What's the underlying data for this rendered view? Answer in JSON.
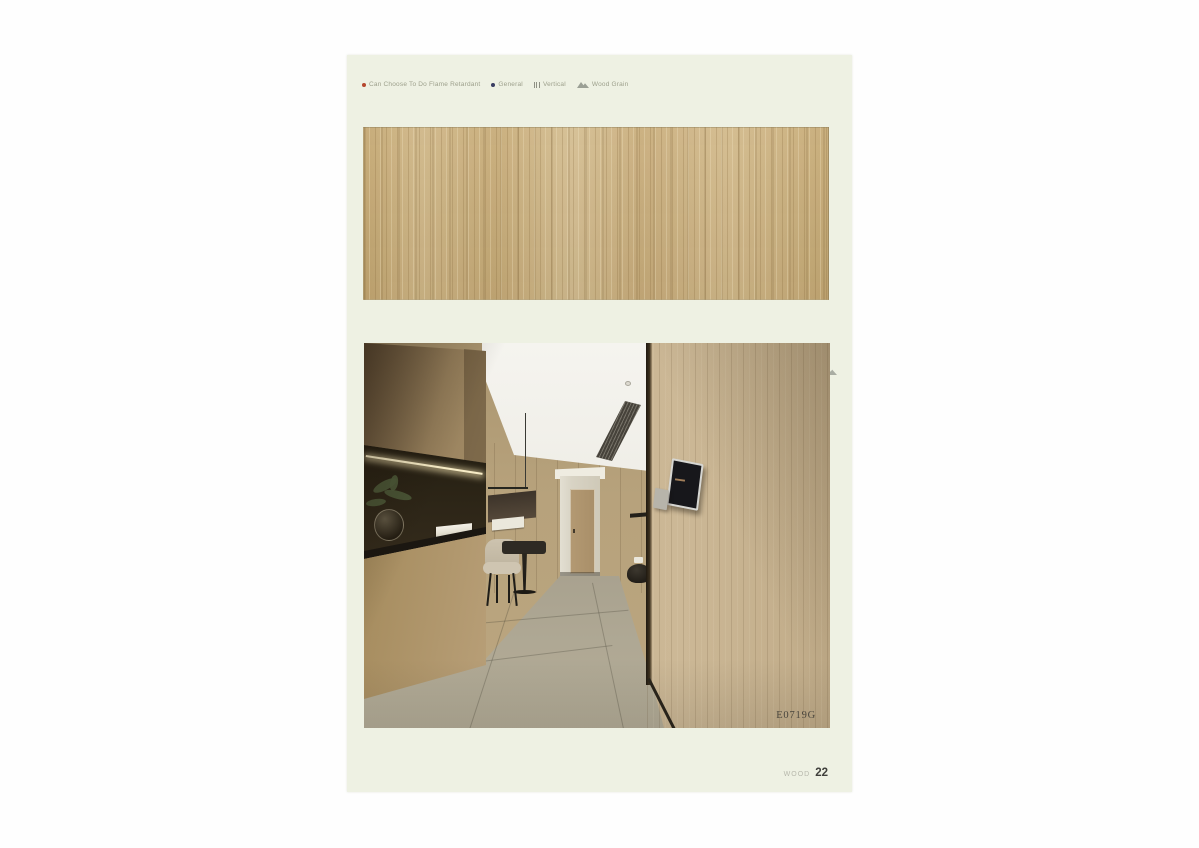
{
  "legend": {
    "items": [
      {
        "icon": "flame-retardant-dot-icon",
        "label": "Can Choose To Do Flame Retardant",
        "color": "#b5472e"
      },
      {
        "icon": "general-dot-icon",
        "label": "General",
        "color": "#3a3e62"
      },
      {
        "icon": "vertical-lines-icon",
        "label": "Vertical"
      },
      {
        "icon": "wood-grain-icon",
        "label": "Wood Grain"
      }
    ]
  },
  "swatch": {
    "name": "Soft white oak",
    "code": "E0719G",
    "markers": [
      "flame-retardant",
      "general",
      "wood-grain"
    ],
    "wood_color": "#c9ad7c"
  },
  "photo": {
    "label": "E0719G"
  },
  "footer": {
    "category": "WOOD",
    "page_number": "22"
  },
  "colors": {
    "page_background": "#eef1e3",
    "flame_dot": "#b5472e",
    "general_dot": "#3a3e62",
    "code_text": "#3a3c3c"
  }
}
